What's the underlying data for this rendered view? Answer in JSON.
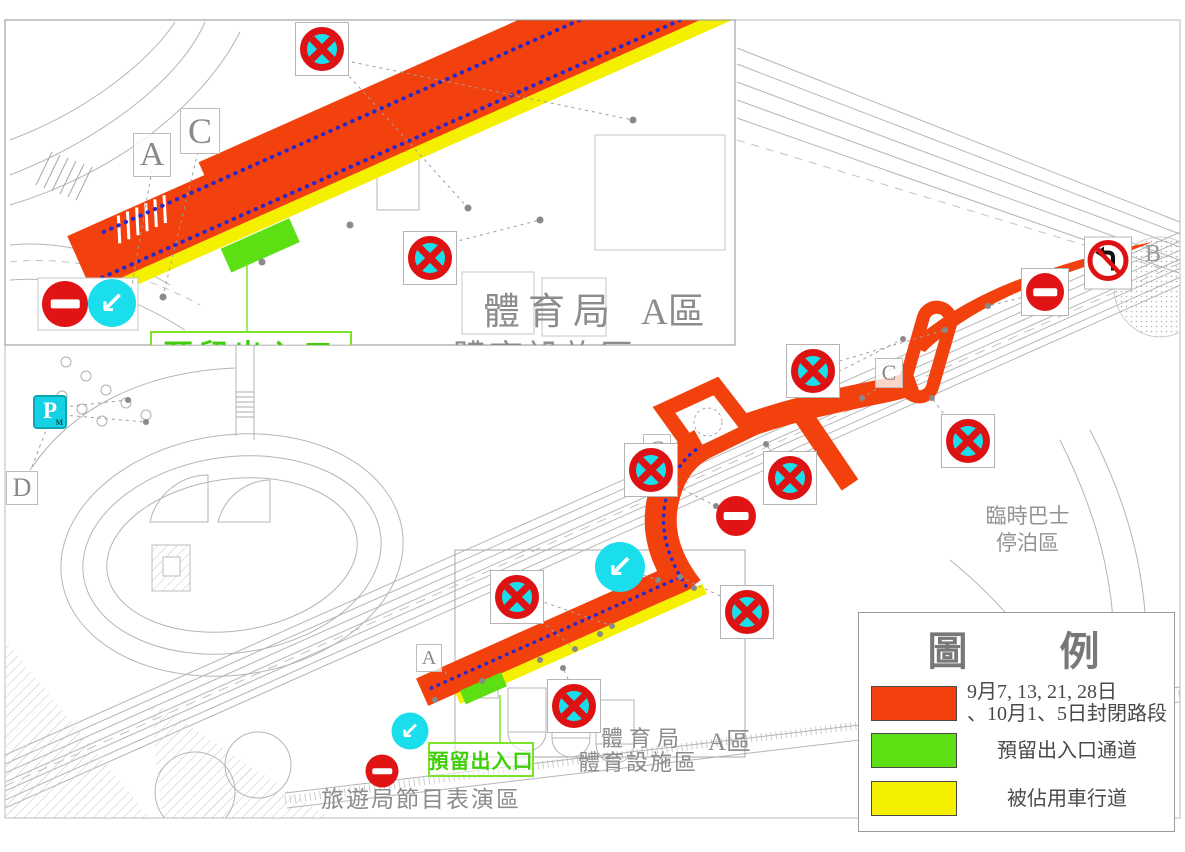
{
  "legend": {
    "title": "圖　例",
    "items": [
      {
        "color": "#f2410d",
        "label_line1": "9月7, 13, 21, 28日",
        "label_line2": "、10月1、5日封閉路段"
      },
      {
        "color": "#5ce013",
        "label": "預留出入口通道"
      },
      {
        "color": "#f4f000",
        "label": "被佔用車行道"
      }
    ]
  },
  "inset": {
    "street_name": "觀光塔街",
    "sports_bureau": "體育局",
    "zone_a": "A區",
    "sports_facility_zone": "體育設施區",
    "reserved_exit": "預留出入口",
    "marker_a": "A",
    "marker_c": "C"
  },
  "main_map": {
    "street_name": "觀光塔街",
    "bus_area_line1": "臨時巴士",
    "bus_area_line2": "停泊區",
    "sports_bureau": "體育局",
    "sports_facility_zone": "體育設施區",
    "zone_a": "A區",
    "reserved_exit": "預留出入口",
    "tourism_area": "旅遊局節目表演區",
    "marker_a": "A",
    "marker_b": "B",
    "marker_c_upper": "C",
    "marker_c_lower": "C",
    "marker_d": "D",
    "parking_sign": "P"
  },
  "colors": {
    "closed_road": "#f2410d",
    "reserved_passage": "#5ce013",
    "occupied_lane": "#f4f000",
    "sign_cyan": "#1bdeec",
    "sign_red": "#de1212",
    "street_blue": "#2525c8"
  }
}
